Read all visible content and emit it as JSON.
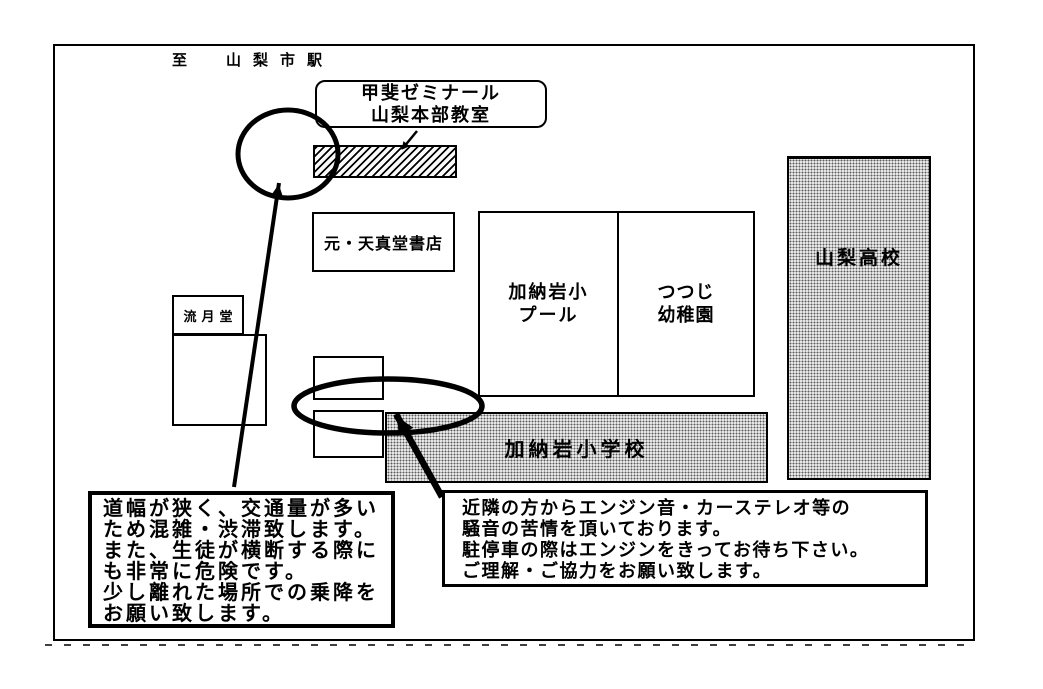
{
  "header": {
    "to_station": "至　山梨市駅"
  },
  "target": {
    "name_line1": "甲斐ゼミナール",
    "name_line2": "山梨本部教室"
  },
  "buildings": {
    "former_bookstore": "元・天真堂書店",
    "ryugetsudo": "流月堂",
    "pool_line1": "加納岩小",
    "pool_line2": "プール",
    "kindergarten_line1": "つつじ",
    "kindergarten_line2": "幼稚園",
    "high_school": "山梨高校",
    "elementary_school": "加納岩小学校"
  },
  "notes": {
    "left": {
      "lines": [
        "道幅が狭く、交通量が多い",
        "ため混雑・渋滞致します。",
        "また、生徒が横断する際に",
        "も非常に危険です。",
        "少し離れた場所での乗降を",
        "お願い致します。"
      ]
    },
    "right": {
      "lines": [
        "近隣の方からエンジン音・カーステレオ等の",
        "騒音の苦情を頂いております。",
        "駐停車の際はエンジンをきってお待ち下さい。",
        "ご理解・ご協力をお願い致します。"
      ]
    }
  },
  "colors": {
    "ink": "#000000",
    "paper": "#ffffff"
  }
}
